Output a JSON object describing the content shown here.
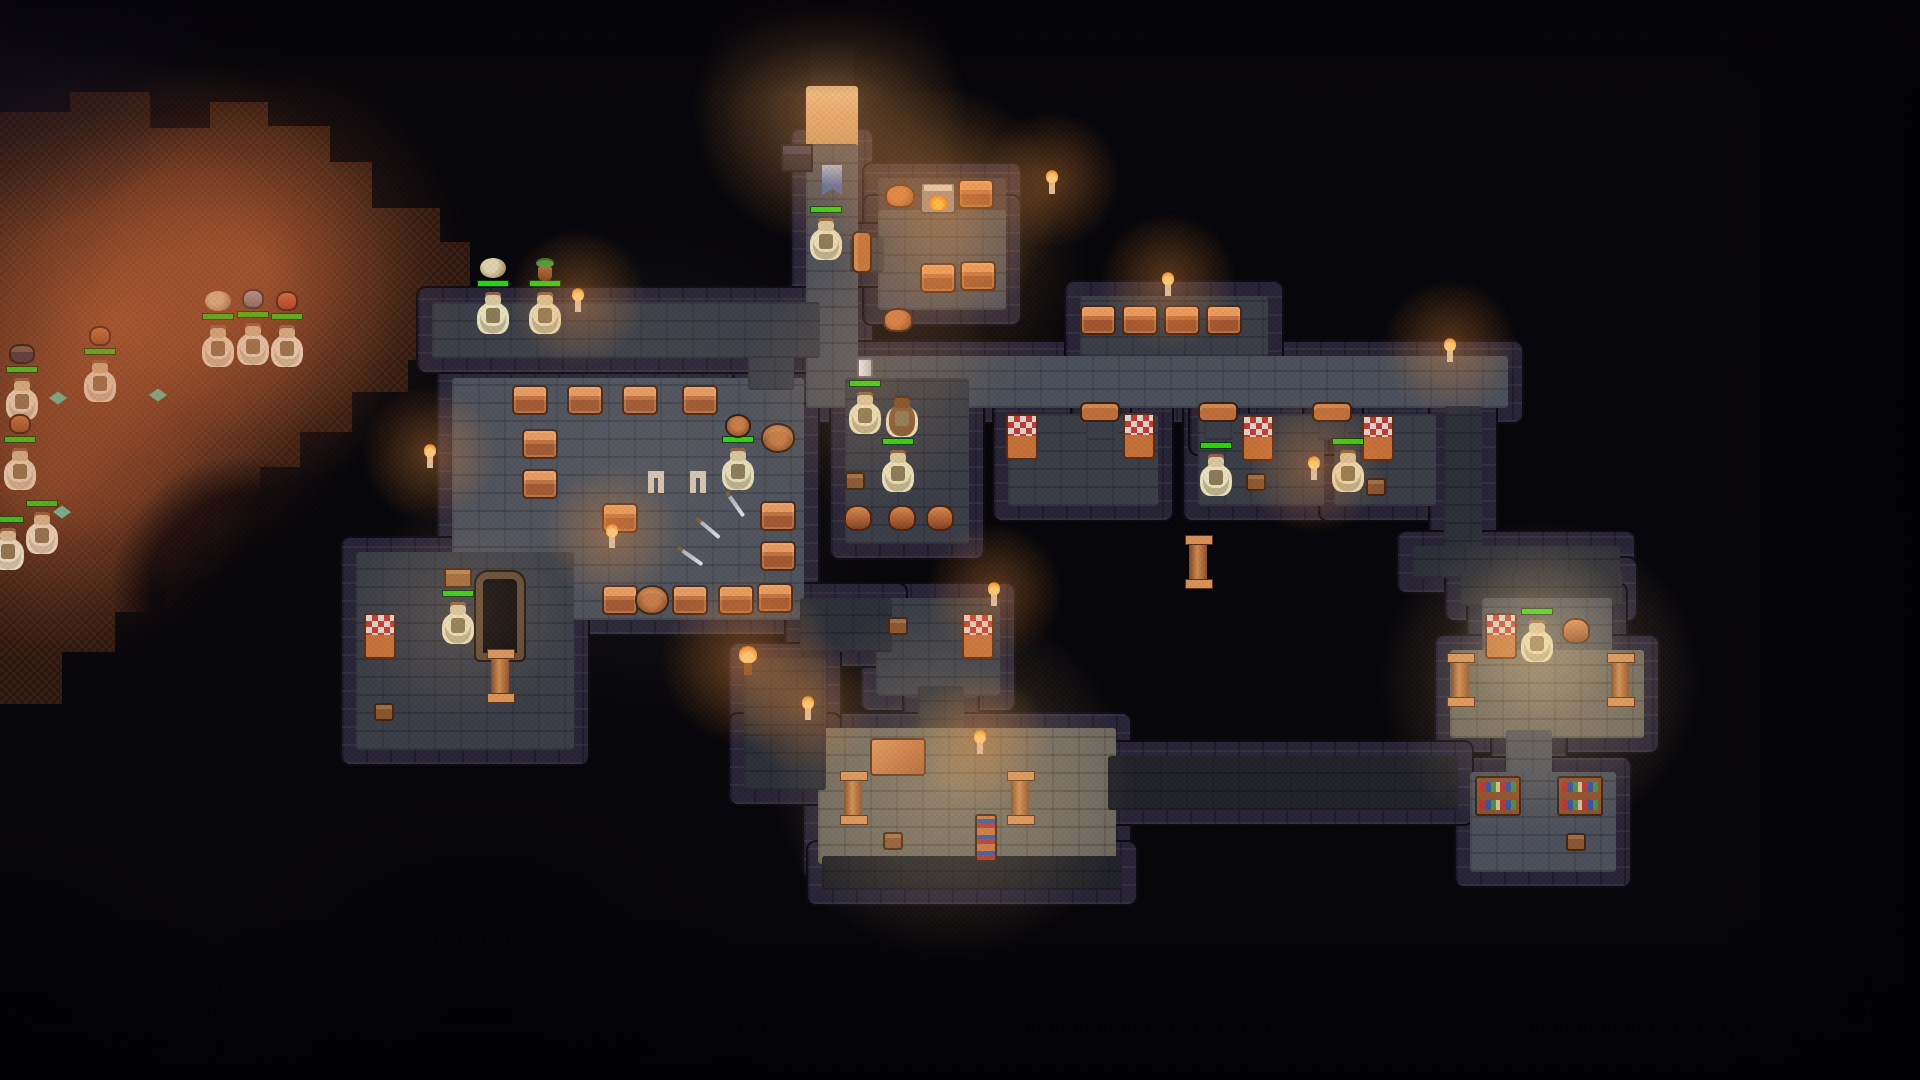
{
  "meta": {
    "title": "Dungeon keeper pixel-art map view",
    "description": "Top-down dungeon with excavated cave, stone rooms, dwarves with health bars"
  },
  "palette": {
    "background": "#060509",
    "wall": "#282436",
    "dirt_deep": "#30180f",
    "dirt_lit": "#a06a4c",
    "floor_mid": "#4c505b",
    "floor_middim": "#3b3e48",
    "floor_dim": "#2e3039",
    "floor_vdim": "#222329",
    "floor_lit": "#6e6960",
    "floor_shelf": "#3a3745",
    "floor_entry": "#d8a878",
    "floor_hole": "#0c0a10",
    "hp_green": "#2ad40e",
    "dwarf_body": "#e9e0bc",
    "chest_copper": "#c1703f",
    "flame_orange": "#ff8c1e"
  },
  "cave": {
    "x": 0,
    "y": 92,
    "w": 470,
    "h": 620,
    "points": [
      [
        0,
        20
      ],
      [
        70,
        20
      ],
      [
        70,
        0
      ],
      [
        150,
        0
      ],
      [
        150,
        36
      ],
      [
        210,
        36
      ],
      [
        210,
        10
      ],
      [
        268,
        10
      ],
      [
        268,
        34
      ],
      [
        330,
        34
      ],
      [
        330,
        70
      ],
      [
        372,
        70
      ],
      [
        372,
        116
      ],
      [
        440,
        116
      ],
      [
        440,
        150
      ],
      [
        470,
        150
      ],
      [
        470,
        268
      ],
      [
        408,
        268
      ],
      [
        408,
        300
      ],
      [
        352,
        300
      ],
      [
        352,
        340
      ],
      [
        300,
        340
      ],
      [
        300,
        375
      ],
      [
        260,
        375
      ],
      [
        260,
        420
      ],
      [
        215,
        420
      ],
      [
        215,
        470
      ],
      [
        165,
        470
      ],
      [
        165,
        520
      ],
      [
        115,
        520
      ],
      [
        115,
        560
      ],
      [
        62,
        560
      ],
      [
        62,
        612
      ],
      [
        0,
        612
      ]
    ]
  },
  "rooms": [
    {
      "name": "entrance-hole",
      "x": 810,
      "y": 44,
      "w": 44,
      "h": 46,
      "shade": "hole"
    },
    {
      "name": "entrance-tile",
      "x": 806,
      "y": 86,
      "w": 52,
      "h": 62,
      "shade": "entry"
    },
    {
      "name": "corridor-entrance",
      "x": 806,
      "y": 144,
      "w": 52,
      "h": 236,
      "shade": "mid"
    },
    {
      "name": "forge-room-shelf",
      "x": 878,
      "y": 178,
      "w": 128,
      "h": 36,
      "shade": "shelf"
    },
    {
      "name": "forge-room",
      "x": 878,
      "y": 210,
      "w": 128,
      "h": 100,
      "shade": "mid"
    },
    {
      "name": "corridor-main",
      "x": 806,
      "y": 356,
      "w": 702,
      "h": 52,
      "shade": "mid"
    },
    {
      "name": "chest-alcove",
      "x": 1080,
      "y": 296,
      "w": 188,
      "h": 60,
      "shade": "middim"
    },
    {
      "name": "forge-door-gap",
      "x": 850,
      "y": 238,
      "w": 34,
      "h": 34,
      "shade": "middim"
    },
    {
      "name": "bedroom-cell-1",
      "x": 1008,
      "y": 414,
      "w": 150,
      "h": 92,
      "shade": "middim"
    },
    {
      "name": "bedroom-cell-2",
      "x": 1198,
      "y": 414,
      "w": 126,
      "h": 92,
      "shade": "middim"
    },
    {
      "name": "bedroom-cell-3",
      "x": 1334,
      "y": 414,
      "w": 102,
      "h": 92,
      "shade": "middim"
    },
    {
      "name": "cell1-door-gap",
      "x": 1086,
      "y": 402,
      "w": 30,
      "h": 38,
      "shade": "middim"
    },
    {
      "name": "cell2-door-gap",
      "x": 1204,
      "y": 402,
      "w": 30,
      "h": 38,
      "shade": "middim"
    },
    {
      "name": "cell3-door-gap",
      "x": 1318,
      "y": 402,
      "w": 30,
      "h": 38,
      "shade": "middim"
    },
    {
      "name": "corridor-right-vert",
      "x": 1444,
      "y": 406,
      "w": 38,
      "h": 154,
      "shade": "dim"
    },
    {
      "name": "corridor-connector",
      "x": 1412,
      "y": 546,
      "w": 208,
      "h": 32,
      "shade": "dim"
    },
    {
      "name": "farright-corr-top",
      "x": 1460,
      "y": 572,
      "w": 162,
      "h": 34,
      "shade": "dim"
    },
    {
      "name": "farright-bedroom",
      "x": 1482,
      "y": 598,
      "w": 130,
      "h": 64,
      "shade": "mid"
    },
    {
      "name": "farright-hall",
      "x": 1450,
      "y": 650,
      "w": 194,
      "h": 88,
      "shade": "lit"
    },
    {
      "name": "farright-neck",
      "x": 1506,
      "y": 730,
      "w": 46,
      "h": 48,
      "shade": "mid"
    },
    {
      "name": "farright-library",
      "x": 1470,
      "y": 772,
      "w": 146,
      "h": 100,
      "shade": "mid"
    },
    {
      "name": "storage-room-central",
      "x": 452,
      "y": 378,
      "w": 352,
      "h": 242,
      "shade": "mid"
    },
    {
      "name": "central-door-gap",
      "x": 748,
      "y": 340,
      "w": 46,
      "h": 50,
      "shade": "middim"
    },
    {
      "name": "corridor-ledge",
      "x": 432,
      "y": 302,
      "w": 388,
      "h": 56,
      "shade": "middim"
    },
    {
      "name": "pot-room",
      "x": 845,
      "y": 378,
      "w": 124,
      "h": 166,
      "shade": "middim"
    },
    {
      "name": "room-leftbottom",
      "x": 356,
      "y": 552,
      "w": 218,
      "h": 198,
      "shade": "middim"
    },
    {
      "name": "bedroom-small",
      "x": 876,
      "y": 598,
      "w": 124,
      "h": 98,
      "shade": "middim"
    },
    {
      "name": "corridor-central-link",
      "x": 800,
      "y": 598,
      "w": 92,
      "h": 54,
      "shade": "dim"
    },
    {
      "name": "corridor-down",
      "x": 918,
      "y": 686,
      "w": 46,
      "h": 52,
      "shade": "dim"
    },
    {
      "name": "hall-bottom",
      "x": 818,
      "y": 728,
      "w": 298,
      "h": 136,
      "shade": "lit"
    },
    {
      "name": "corridor-bottomleft",
      "x": 744,
      "y": 658,
      "w": 82,
      "h": 122,
      "shade": "dim"
    },
    {
      "name": "corridor-bottomleft-2",
      "x": 744,
      "y": 728,
      "w": 82,
      "h": 62,
      "shade": "dim"
    },
    {
      "name": "corridor-dim-right",
      "x": 1108,
      "y": 756,
      "w": 350,
      "h": 54,
      "shade": "vdim"
    },
    {
      "name": "corridor-dim-bottom",
      "x": 822,
      "y": 856,
      "w": 300,
      "h": 34,
      "shade": "vdim"
    }
  ],
  "entities": [
    {
      "type": "crate-dark",
      "x": 797,
      "y": 158
    },
    {
      "type": "banner",
      "x": 832,
      "y": 180
    },
    {
      "type": "dwarf",
      "x": 826,
      "y": 238,
      "hp": true
    },
    {
      "type": "sack",
      "x": 900,
      "y": 196
    },
    {
      "type": "forge",
      "x": 938,
      "y": 198
    },
    {
      "type": "chest",
      "x": 976,
      "y": 194
    },
    {
      "type": "chest",
      "x": 938,
      "y": 278
    },
    {
      "type": "chest",
      "x": 978,
      "y": 276
    },
    {
      "type": "sack",
      "x": 898,
      "y": 320
    },
    {
      "type": "door-v",
      "x": 862,
      "y": 252
    },
    {
      "type": "candle",
      "x": 1052,
      "y": 188
    },
    {
      "type": "chest",
      "x": 1098,
      "y": 320
    },
    {
      "type": "chest",
      "x": 1140,
      "y": 320
    },
    {
      "type": "chest",
      "x": 1182,
      "y": 320
    },
    {
      "type": "chest",
      "x": 1224,
      "y": 320
    },
    {
      "type": "candle",
      "x": 1168,
      "y": 290
    },
    {
      "type": "candle",
      "x": 1450,
      "y": 356
    },
    {
      "type": "door-h",
      "x": 1100,
      "y": 412
    },
    {
      "type": "door-h",
      "x": 1218,
      "y": 412
    },
    {
      "type": "door-h",
      "x": 1332,
      "y": 412
    },
    {
      "type": "bed",
      "x": 1022,
      "y": 437
    },
    {
      "type": "bed",
      "x": 1139,
      "y": 436
    },
    {
      "type": "bed",
      "x": 1258,
      "y": 438
    },
    {
      "type": "dwarf",
      "x": 1216,
      "y": 474,
      "hp": true
    },
    {
      "type": "stool",
      "x": 1256,
      "y": 482
    },
    {
      "type": "candle",
      "x": 1314,
      "y": 474
    },
    {
      "type": "bed",
      "x": 1378,
      "y": 438
    },
    {
      "type": "dwarf",
      "x": 1348,
      "y": 470,
      "hp": true
    },
    {
      "type": "stool",
      "x": 1376,
      "y": 487
    },
    {
      "type": "pillar",
      "x": 1198,
      "y": 562
    },
    {
      "type": "dwarf",
      "x": 493,
      "y": 312,
      "hp": true,
      "carry": "boulder"
    },
    {
      "type": "dwarf",
      "x": 545,
      "y": 312,
      "hp": true,
      "carry": "plantpot"
    },
    {
      "type": "candle",
      "x": 578,
      "y": 306
    },
    {
      "type": "candle",
      "x": 430,
      "y": 462
    },
    {
      "type": "chest",
      "x": 530,
      "y": 400
    },
    {
      "type": "chest",
      "x": 585,
      "y": 400
    },
    {
      "type": "chest",
      "x": 640,
      "y": 400
    },
    {
      "type": "chest",
      "x": 700,
      "y": 400
    },
    {
      "type": "barrel",
      "x": 778,
      "y": 438
    },
    {
      "type": "chest",
      "x": 540,
      "y": 444
    },
    {
      "type": "chest",
      "x": 540,
      "y": 484
    },
    {
      "type": "chest",
      "x": 620,
      "y": 518
    },
    {
      "type": "chest",
      "x": 778,
      "y": 516
    },
    {
      "type": "chest",
      "x": 778,
      "y": 556
    },
    {
      "type": "chest",
      "x": 620,
      "y": 600
    },
    {
      "type": "barrel",
      "x": 652,
      "y": 600
    },
    {
      "type": "chest",
      "x": 690,
      "y": 600
    },
    {
      "type": "chest",
      "x": 736,
      "y": 600
    },
    {
      "type": "chest",
      "x": 775,
      "y": 598
    },
    {
      "type": "leggings",
      "x": 656,
      "y": 482
    },
    {
      "type": "leggings",
      "x": 698,
      "y": 482
    },
    {
      "type": "sword",
      "x": 708,
      "y": 528,
      "rot": 40
    },
    {
      "type": "sword",
      "x": 690,
      "y": 556,
      "rot": 35
    },
    {
      "type": "sword",
      "x": 735,
      "y": 504,
      "rot": 55
    },
    {
      "type": "candle",
      "x": 612,
      "y": 542
    },
    {
      "type": "dwarf",
      "x": 738,
      "y": 468,
      "hp": true,
      "carry": "barrel"
    },
    {
      "type": "dwarf",
      "x": 865,
      "y": 412,
      "hp": true,
      "carry": "tankard"
    },
    {
      "type": "dwarf",
      "x": 902,
      "y": 415,
      "variant": "brown"
    },
    {
      "type": "dwarf",
      "x": 898,
      "y": 470,
      "hp": true
    },
    {
      "type": "stool",
      "x": 855,
      "y": 481
    },
    {
      "type": "pot",
      "x": 858,
      "y": 518
    },
    {
      "type": "pot",
      "x": 902,
      "y": 518
    },
    {
      "type": "pot",
      "x": 940,
      "y": 518
    },
    {
      "type": "bed",
      "x": 380,
      "y": 636
    },
    {
      "type": "stool",
      "x": 384,
      "y": 712
    },
    {
      "type": "dwarf",
      "x": 458,
      "y": 622,
      "hp": true,
      "carry": "crate"
    },
    {
      "type": "bigdoor",
      "x": 500,
      "y": 616
    },
    {
      "type": "pillar",
      "x": 500,
      "y": 676
    },
    {
      "type": "stool",
      "x": 898,
      "y": 626
    },
    {
      "type": "bed",
      "x": 978,
      "y": 636
    },
    {
      "type": "candle",
      "x": 994,
      "y": 600
    },
    {
      "type": "torch",
      "x": 748,
      "y": 668
    },
    {
      "type": "candle",
      "x": 808,
      "y": 714
    },
    {
      "type": "table",
      "x": 898,
      "y": 757
    },
    {
      "type": "pillar",
      "x": 853,
      "y": 798
    },
    {
      "type": "pillar",
      "x": 1020,
      "y": 798
    },
    {
      "type": "stool",
      "x": 893,
      "y": 841
    },
    {
      "type": "bookshelf-v",
      "x": 986,
      "y": 838
    },
    {
      "type": "candle",
      "x": 980,
      "y": 748
    },
    {
      "type": "bed",
      "x": 1501,
      "y": 636
    },
    {
      "type": "dwarf",
      "x": 1537,
      "y": 640,
      "hp": true
    },
    {
      "type": "pot",
      "x": 1576,
      "y": 631
    },
    {
      "type": "pillar",
      "x": 1460,
      "y": 680
    },
    {
      "type": "pillar",
      "x": 1620,
      "y": 680
    },
    {
      "type": "bookshelf",
      "x": 1498,
      "y": 796
    },
    {
      "type": "bookshelf",
      "x": 1580,
      "y": 796
    },
    {
      "type": "stool",
      "x": 1576,
      "y": 842
    },
    {
      "type": "dwarf",
      "x": 100,
      "y": 380,
      "hp": true,
      "carry": "pot",
      "variant": "pale"
    },
    {
      "type": "dwarf",
      "x": 22,
      "y": 398,
      "hp": true,
      "carry": "darkpot",
      "variant": "pale"
    },
    {
      "type": "dwarf",
      "x": 20,
      "y": 468,
      "hp": true,
      "carry": "pot",
      "variant": "pale"
    },
    {
      "type": "dwarf",
      "x": 42,
      "y": 532,
      "hp": true,
      "variant": "pale"
    },
    {
      "type": "dwarf",
      "x": 8,
      "y": 548,
      "hp": true,
      "variant": "pale"
    },
    {
      "type": "dwarf",
      "x": 218,
      "y": 345,
      "hp": true,
      "carry": "boulder",
      "variant": "pale"
    },
    {
      "type": "dwarf",
      "x": 253,
      "y": 343,
      "hp": true,
      "carry": "pot-gray",
      "variant": "pale"
    },
    {
      "type": "dwarf",
      "x": 287,
      "y": 345,
      "hp": true,
      "carry": "pot-red",
      "variant": "pale"
    },
    {
      "type": "gem",
      "x": 58,
      "y": 398
    },
    {
      "type": "gem",
      "x": 158,
      "y": 395
    },
    {
      "type": "gem",
      "x": 62,
      "y": 512
    }
  ],
  "lights": [
    {
      "x": 830,
      "y": 110,
      "r": 150,
      "c": "rgba(255,170,90,.45)"
    },
    {
      "x": 120,
      "y": 320,
      "r": 300,
      "c": "rgba(205,100,55,.38)"
    },
    {
      "x": 250,
      "y": 270,
      "r": 240,
      "c": "rgba(205,100,55,.32)"
    },
    {
      "x": 60,
      "y": 470,
      "r": 220,
      "c": "rgba(190,90,50,.28)"
    },
    {
      "x": 940,
      "y": 205,
      "r": 130,
      "c": "rgba(255,160,70,.40)"
    },
    {
      "x": 940,
      "y": 265,
      "r": 160,
      "c": "rgba(255,170,90,.20)"
    },
    {
      "x": 640,
      "y": 470,
      "r": 280,
      "c": "rgba(190,180,150,.10)"
    },
    {
      "x": 1540,
      "y": 680,
      "r": 175,
      "c": "rgba(255,210,140,.30)"
    },
    {
      "x": 1540,
      "y": 630,
      "r": 95,
      "c": "rgba(255,215,150,.25)"
    },
    {
      "x": 950,
      "y": 780,
      "r": 195,
      "c": "rgba(255,210,140,.28)"
    },
    {
      "x": 870,
      "y": 382,
      "r": 140,
      "c": "rgba(255,180,100,.18)"
    },
    {
      "x": 460,
      "y": 615,
      "r": 120,
      "c": "rgba(255,190,120,.16)"
    }
  ]
}
